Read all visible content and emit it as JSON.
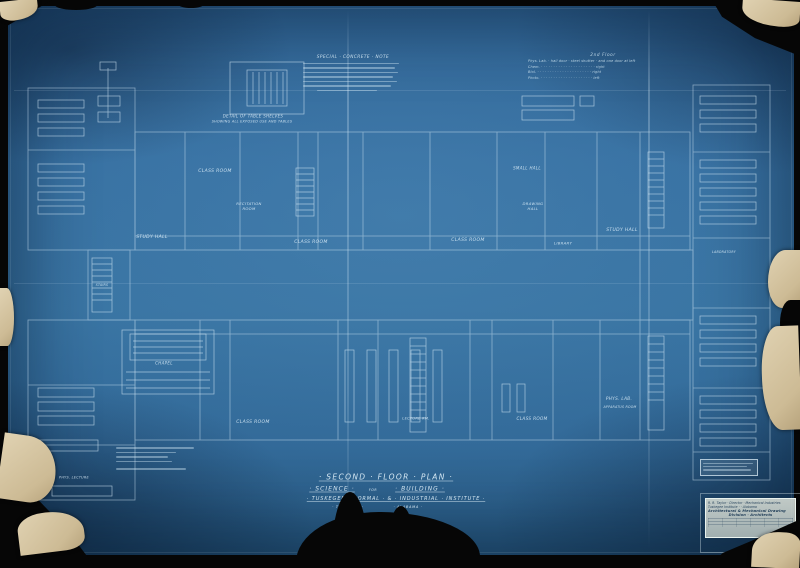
{
  "palette": {
    "paper_blue": "#35709f",
    "line_white": "#cfe4f2",
    "torn_paper": "#d8c8a6",
    "backdrop_black": "#060606",
    "stamp_bg": "#d8ded6",
    "stamp_text": "#203d58"
  },
  "title_block": {
    "line1": "· Second · Floor · Plan ·",
    "line2a": "· Science ·",
    "line2b": "for",
    "line2c": "· Building ·",
    "line3": "· Tuskegee · Normal · & · Industrial · Institute ·",
    "line4a": "· Tuskegee ·",
    "line4b": "· Alabama ·"
  },
  "notes": {
    "concrete_note_heading": "Special · Concrete · Note",
    "detail_caption1": "Detail of Table Shelves",
    "detail_caption2": "Showing all exposed use and tables"
  },
  "schedule": {
    "heading": "2nd Floor",
    "rows": [
      "Phys. Lab. · hall door · steel shutter · and one door at left",
      "Chem. · · · · · · · · · · · · · · · · · · · · · · right",
      "Biol. · · · · · · · · · · · · · · · · · · · · · · right",
      "Photo. · · · · · · · · · · · · · · · · · · · · · left"
    ]
  },
  "stamp": {
    "line1": "R. R. Taylor · Director · Mechanical Industries",
    "line2": "Tuskegee Institute · · Alabama",
    "line3": "Architectural & Mechanical Drawing",
    "line4": "Division · Architects"
  },
  "room_labels": [
    {
      "text": "Class Room",
      "x": 215,
      "y": 172,
      "fs": 4.5
    },
    {
      "text": "Recitation\nRoom",
      "x": 249,
      "y": 206,
      "fs": 3.8
    },
    {
      "text": "Study Hall",
      "x": 152,
      "y": 238,
      "fs": 4.5
    },
    {
      "text": "Class Room",
      "x": 311,
      "y": 243,
      "fs": 4.5
    },
    {
      "text": "Class Room",
      "x": 468,
      "y": 241,
      "fs": 4.5
    },
    {
      "text": "Study Hall",
      "x": 622,
      "y": 231,
      "fs": 4.5
    },
    {
      "text": "Small Hall",
      "x": 527,
      "y": 168,
      "fs": 4
    },
    {
      "text": "Drawing\nHall",
      "x": 533,
      "y": 206,
      "fs": 3.8
    },
    {
      "text": "Library",
      "x": 563,
      "y": 243,
      "fs": 3.8
    },
    {
      "text": "Class Room",
      "x": 253,
      "y": 423,
      "fs": 4.5
    },
    {
      "text": "Class Room",
      "x": 532,
      "y": 419,
      "fs": 4.2
    },
    {
      "text": "Phys. Lab.",
      "x": 619,
      "y": 399,
      "fs": 4.2
    },
    {
      "text": "Apparatus Room",
      "x": 620,
      "y": 407,
      "fs": 3.2
    },
    {
      "text": "Chapel",
      "x": 164,
      "y": 363,
      "fs": 4
    },
    {
      "text": "Lecture Rm.",
      "x": 416,
      "y": 419,
      "fs": 3.6
    },
    {
      "text": "Phys. Lecture",
      "x": 74,
      "y": 478,
      "fs": 3.4
    },
    {
      "text": "Laboratory",
      "x": 724,
      "y": 252,
      "fs": 3.2
    },
    {
      "text": "Stairs",
      "x": 102,
      "y": 285,
      "fs": 3.2
    }
  ]
}
